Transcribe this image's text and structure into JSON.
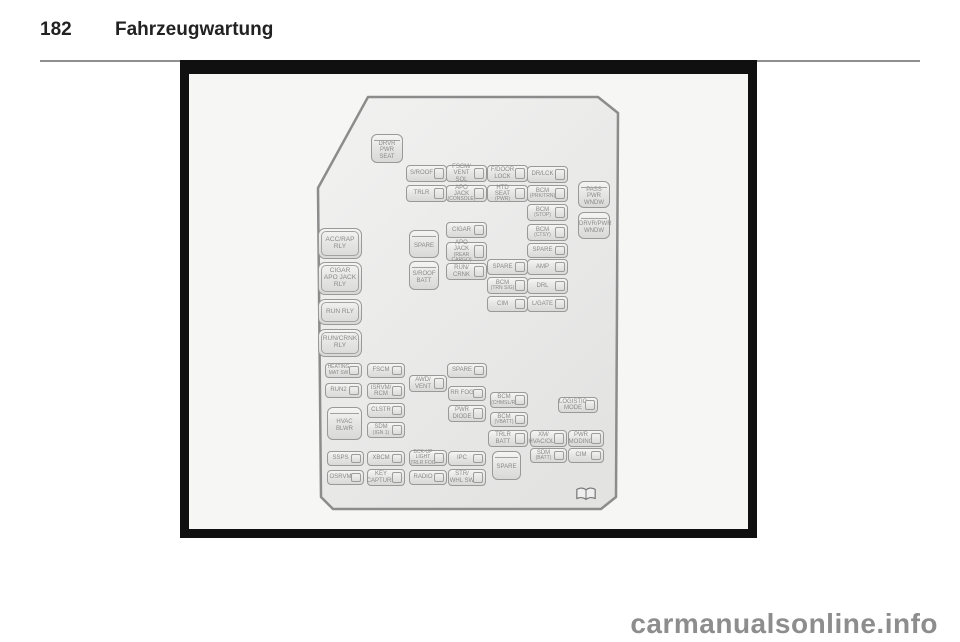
{
  "header": {
    "page_number": "182",
    "title": "Fahrzeugwartung"
  },
  "watermark": {
    "text": "carmanualsonline.info"
  },
  "figure": {
    "background": "#f6f6f5",
    "frame_color": "#101010",
    "outline_color": "#8c8c8c",
    "fuse_border_color": "#999999",
    "label_color": "#8a8a8a",
    "book_icon": "open-book",
    "fuses": [
      {
        "id": "drvr-pwr-seat",
        "type": "big",
        "x": 371,
        "y": 134,
        "w": 32,
        "h": 29,
        "lines": [
          "DRVR",
          "PWR",
          "SEAT"
        ],
        "sub": []
      },
      {
        "id": "s-roof",
        "type": "small",
        "x": 406,
        "y": 165,
        "w": 41,
        "h": 17,
        "lines": [
          "S/ROOF"
        ],
        "sub": []
      },
      {
        "id": "fscm-vent-sol",
        "type": "small",
        "x": 446,
        "y": 165,
        "w": 41,
        "h": 17,
        "lines": [
          "FSCM/",
          "VENT SOL"
        ],
        "sub": []
      },
      {
        "id": "f-door-lock",
        "type": "small",
        "x": 487,
        "y": 165,
        "w": 41,
        "h": 17,
        "lines": [
          "F/DOOR",
          "LOCK"
        ],
        "sub": []
      },
      {
        "id": "dr-lck",
        "type": "small",
        "x": 527,
        "y": 166,
        "w": 41,
        "h": 17,
        "lines": [
          "DR/LCK"
        ],
        "sub": []
      },
      {
        "id": "trlr",
        "type": "small",
        "x": 406,
        "y": 185,
        "w": 41,
        "h": 17,
        "lines": [
          "TRLR"
        ],
        "sub": []
      },
      {
        "id": "apo-jack-console",
        "type": "small",
        "x": 446,
        "y": 185,
        "w": 41,
        "h": 17,
        "lines": [
          "APO JACK"
        ],
        "sub": [
          "(CONSOLE)"
        ]
      },
      {
        "id": "htd-seat-pwr",
        "type": "small",
        "x": 487,
        "y": 185,
        "w": 41,
        "h": 17,
        "lines": [
          "HTD SEAT"
        ],
        "sub": [
          "(PWR)"
        ]
      },
      {
        "id": "bcm-prk-trn",
        "type": "small",
        "x": 527,
        "y": 185,
        "w": 41,
        "h": 17,
        "lines": [
          "BCM"
        ],
        "sub": [
          "(PRK/TRN)"
        ]
      },
      {
        "id": "bcm-stop",
        "type": "small",
        "x": 527,
        "y": 204,
        "w": 41,
        "h": 17,
        "lines": [
          "BCM"
        ],
        "sub": [
          "(STOP)"
        ]
      },
      {
        "id": "cigar",
        "type": "small",
        "x": 446,
        "y": 222,
        "w": 41,
        "h": 16,
        "lines": [
          "CIGAR"
        ],
        "sub": []
      },
      {
        "id": "bcm-ctsy",
        "type": "small",
        "x": 527,
        "y": 224,
        "w": 41,
        "h": 17,
        "lines": [
          "BCM"
        ],
        "sub": [
          "(CTSY)"
        ]
      },
      {
        "id": "spare-1",
        "type": "big",
        "x": 409,
        "y": 230,
        "w": 30,
        "h": 28,
        "lines": [
          "SPARE"
        ],
        "sub": []
      },
      {
        "id": "apo-jack-rear-cargo",
        "type": "small",
        "x": 446,
        "y": 242,
        "w": 41,
        "h": 19,
        "lines": [
          "APO JACK"
        ],
        "sub": [
          "(REAR",
          "CARGO)"
        ]
      },
      {
        "id": "spare-2",
        "type": "small",
        "x": 527,
        "y": 243,
        "w": 41,
        "h": 15,
        "lines": [
          "SPARE"
        ],
        "sub": []
      },
      {
        "id": "spare-3",
        "type": "small",
        "x": 487,
        "y": 259,
        "w": 41,
        "h": 16,
        "lines": [
          "SPARE"
        ],
        "sub": []
      },
      {
        "id": "amp",
        "type": "small",
        "x": 527,
        "y": 259,
        "w": 41,
        "h": 16,
        "lines": [
          "AMP"
        ],
        "sub": []
      },
      {
        "id": "s-roof-batt",
        "type": "big",
        "x": 409,
        "y": 261,
        "w": 30,
        "h": 29,
        "lines": [
          "S/ROOF",
          "BATT"
        ],
        "sub": []
      },
      {
        "id": "run-crnk",
        "type": "small",
        "x": 446,
        "y": 263,
        "w": 41,
        "h": 17,
        "lines": [
          "RUN/",
          "CRNK"
        ],
        "sub": []
      },
      {
        "id": "bcm-trn-sig",
        "type": "small",
        "x": 487,
        "y": 277,
        "w": 41,
        "h": 17,
        "lines": [
          "BCM"
        ],
        "sub": [
          "(TRN SIG)"
        ]
      },
      {
        "id": "drl",
        "type": "small",
        "x": 527,
        "y": 278,
        "w": 41,
        "h": 16,
        "lines": [
          "DRL"
        ],
        "sub": []
      },
      {
        "id": "cim-1",
        "type": "small",
        "x": 487,
        "y": 296,
        "w": 41,
        "h": 16,
        "lines": [
          "CIM"
        ],
        "sub": []
      },
      {
        "id": "l-gate",
        "type": "small",
        "x": 527,
        "y": 296,
        "w": 41,
        "h": 16,
        "lines": [
          "L/GATE"
        ],
        "sub": []
      },
      {
        "id": "pass-pwr-wndw",
        "type": "big",
        "x": 578,
        "y": 181,
        "w": 32,
        "h": 27,
        "lines": [
          "PASS",
          "PWR",
          "WNDW"
        ],
        "sub": []
      },
      {
        "id": "drvr-pwr-wndw",
        "type": "big",
        "x": 578,
        "y": 212,
        "w": 32,
        "h": 27,
        "lines": [
          "DRVR/PWR",
          "WNDW"
        ],
        "sub": []
      },
      {
        "id": "acc-rap-rly",
        "type": "relay",
        "x": 318,
        "y": 228,
        "w": 44,
        "h": 31,
        "lines": [
          "ACC/RAP",
          "RLY"
        ],
        "sub": []
      },
      {
        "id": "cigar-apo-jack-rly",
        "type": "relay",
        "x": 318,
        "y": 262,
        "w": 44,
        "h": 33,
        "lines": [
          "CIGAR",
          "APO JACK",
          "RLY"
        ],
        "sub": []
      },
      {
        "id": "run-rly",
        "type": "relay",
        "x": 318,
        "y": 299,
        "w": 44,
        "h": 26,
        "lines": [
          "RUN RLY"
        ],
        "sub": []
      },
      {
        "id": "run-crnk-rly",
        "type": "relay",
        "x": 318,
        "y": 329,
        "w": 44,
        "h": 28,
        "lines": [
          "RUN/CRNK",
          "RLY"
        ],
        "sub": []
      },
      {
        "id": "heating-mat-sw",
        "type": "small",
        "x": 325,
        "y": 363,
        "w": 37,
        "h": 15,
        "lines": [],
        "sub": [
          "HEATING",
          "MAT SW"
        ]
      },
      {
        "id": "fscm",
        "type": "small",
        "x": 367,
        "y": 363,
        "w": 38,
        "h": 15,
        "lines": [
          "FSCM"
        ],
        "sub": []
      },
      {
        "id": "spare-4",
        "type": "small",
        "x": 447,
        "y": 363,
        "w": 40,
        "h": 15,
        "lines": [
          "SPARE"
        ],
        "sub": []
      },
      {
        "id": "awd-vent",
        "type": "small",
        "x": 409,
        "y": 375,
        "w": 38,
        "h": 17,
        "lines": [
          "AWD/",
          "VENT"
        ],
        "sub": []
      },
      {
        "id": "run2",
        "type": "small",
        "x": 325,
        "y": 383,
        "w": 37,
        "h": 15,
        "lines": [
          "RUN2"
        ],
        "sub": []
      },
      {
        "id": "isrvm-rcm",
        "type": "small",
        "x": 367,
        "y": 383,
        "w": 38,
        "h": 16,
        "lines": [
          "ISRVM/",
          "RCM"
        ],
        "sub": []
      },
      {
        "id": "rr-fog",
        "type": "small",
        "x": 448,
        "y": 386,
        "w": 38,
        "h": 15,
        "lines": [
          "RR FOG"
        ],
        "sub": []
      },
      {
        "id": "bcm-chmsl-r",
        "type": "small",
        "x": 490,
        "y": 392,
        "w": 38,
        "h": 16,
        "lines": [
          "BCM"
        ],
        "sub": [
          "(CHMSL/R)"
        ]
      },
      {
        "id": "logistic-mode",
        "type": "small",
        "x": 558,
        "y": 397,
        "w": 40,
        "h": 16,
        "lines": [
          "LOGISTIC",
          "MODE"
        ],
        "sub": []
      },
      {
        "id": "clstr",
        "type": "small",
        "x": 367,
        "y": 403,
        "w": 38,
        "h": 15,
        "lines": [
          "CLSTR"
        ],
        "sub": []
      },
      {
        "id": "pwr-diode",
        "type": "small",
        "x": 448,
        "y": 405,
        "w": 38,
        "h": 17,
        "lines": [
          "PWR",
          "DIODE"
        ],
        "sub": []
      },
      {
        "id": "hvac-blwr",
        "type": "big",
        "x": 327,
        "y": 407,
        "w": 35,
        "h": 33,
        "lines": [
          "HVAC",
          "BLWR"
        ],
        "sub": []
      },
      {
        "id": "bcm-vbatt",
        "type": "small",
        "x": 490,
        "y": 412,
        "w": 38,
        "h": 15,
        "lines": [
          "BCM"
        ],
        "sub": [
          "(VBATT)"
        ]
      },
      {
        "id": "sdm-ign1",
        "type": "small",
        "x": 367,
        "y": 422,
        "w": 38,
        "h": 16,
        "lines": [
          "SDM"
        ],
        "sub": [
          "(IGN 1)"
        ]
      },
      {
        "id": "trlr-batt",
        "type": "small",
        "x": 488,
        "y": 430,
        "w": 40,
        "h": 17,
        "lines": [
          "TRLR",
          "BATT"
        ],
        "sub": []
      },
      {
        "id": "xm-hvac-olc",
        "type": "small",
        "x": 530,
        "y": 430,
        "w": 37,
        "h": 17,
        "lines": [
          "XM/",
          "HVAC/OLC"
        ],
        "sub": []
      },
      {
        "id": "pwr-moding",
        "type": "small",
        "x": 568,
        "y": 430,
        "w": 36,
        "h": 17,
        "lines": [
          "PWR",
          "MODING"
        ],
        "sub": []
      },
      {
        "id": "sdm-batt",
        "type": "small",
        "x": 530,
        "y": 448,
        "w": 37,
        "h": 15,
        "lines": [
          "SDM"
        ],
        "sub": [
          "(BATT)"
        ]
      },
      {
        "id": "cim-2",
        "type": "small",
        "x": 568,
        "y": 448,
        "w": 36,
        "h": 15,
        "lines": [
          "CIM"
        ],
        "sub": []
      },
      {
        "id": "ssps",
        "type": "small",
        "x": 327,
        "y": 451,
        "w": 37,
        "h": 15,
        "lines": [
          "SSPS"
        ],
        "sub": []
      },
      {
        "id": "xbcm",
        "type": "small",
        "x": 367,
        "y": 451,
        "w": 38,
        "h": 15,
        "lines": [
          "XBCM"
        ],
        "sub": []
      },
      {
        "id": "bckup-light-trlr-fog",
        "type": "small",
        "x": 409,
        "y": 450,
        "w": 38,
        "h": 16,
        "lines": [],
        "sub": [
          "BCK-UP LIGHT",
          "TRLR FOG"
        ]
      },
      {
        "id": "ipc",
        "type": "small",
        "x": 448,
        "y": 451,
        "w": 38,
        "h": 15,
        "lines": [
          "IPC"
        ],
        "sub": []
      },
      {
        "id": "spare-5",
        "type": "big",
        "x": 492,
        "y": 451,
        "w": 29,
        "h": 29,
        "lines": [
          "SPARE"
        ],
        "sub": []
      },
      {
        "id": "osrvm",
        "type": "small",
        "x": 327,
        "y": 470,
        "w": 37,
        "h": 15,
        "lines": [
          "OSRVM"
        ],
        "sub": []
      },
      {
        "id": "key-capture",
        "type": "small",
        "x": 367,
        "y": 469,
        "w": 38,
        "h": 17,
        "lines": [
          "KEY",
          "CAPTURE"
        ],
        "sub": []
      },
      {
        "id": "radio",
        "type": "small",
        "x": 409,
        "y": 470,
        "w": 38,
        "h": 15,
        "lines": [
          "RADIO"
        ],
        "sub": []
      },
      {
        "id": "str-whl-sw",
        "type": "small",
        "x": 448,
        "y": 469,
        "w": 38,
        "h": 17,
        "lines": [
          "STR/",
          "WHL SW"
        ],
        "sub": []
      }
    ]
  }
}
